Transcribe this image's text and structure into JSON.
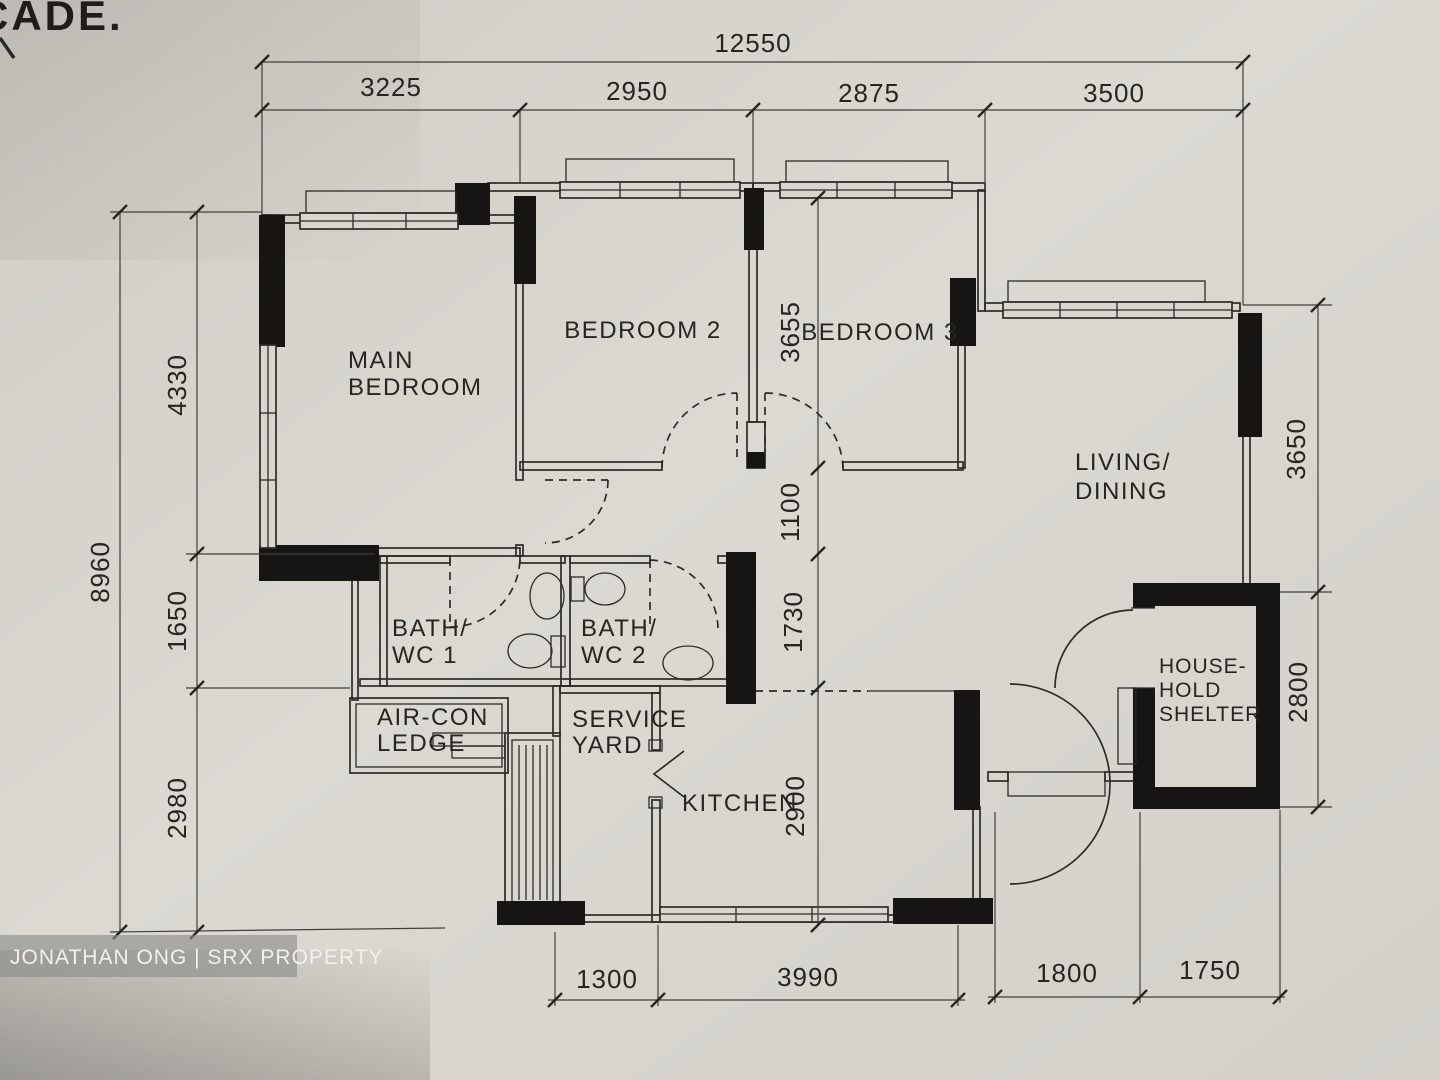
{
  "meta": {
    "corner_text": "CADE.",
    "watermark": "JONATHAN ONG | SRX PROPERTY"
  },
  "rooms": {
    "main_bedroom": {
      "line1": "MAIN",
      "line2": "BEDROOM"
    },
    "bedroom2": "BEDROOM 2",
    "bedroom3": "BEDROOM 3",
    "living": {
      "line1": "LIVING/",
      "line2": "DINING"
    },
    "bath1": {
      "line1": "BATH/",
      "line2": "WC 1"
    },
    "bath2": {
      "line1": "BATH/",
      "line2": "WC 2"
    },
    "aircon": {
      "line1": "AIR-CON",
      "line2": "LEDGE"
    },
    "service": {
      "line1": "SERVICE",
      "line2": "YARD"
    },
    "kitchen": "KITCHEN",
    "shelter": {
      "line1": "HOUSE-",
      "line2": "HOLD",
      "line3": "SHELTER"
    }
  },
  "dims": {
    "top_total": "12550",
    "top": [
      "3225",
      "2950",
      "2875",
      "3500"
    ],
    "left_total": "8960",
    "left": [
      "4330",
      "1650",
      "2980"
    ],
    "mid": [
      "3655",
      "1100",
      "1730",
      "2900"
    ],
    "right": [
      "3650",
      "2800"
    ],
    "bottom": [
      "1300",
      "3990",
      "1800",
      "1750"
    ]
  },
  "colors": {
    "paper": "#d8d6cf",
    "ink": "#2c2b28",
    "wall_black": "#161513",
    "watermark_bg": "#8a8a87",
    "watermark_text": "#f2f1ee"
  }
}
